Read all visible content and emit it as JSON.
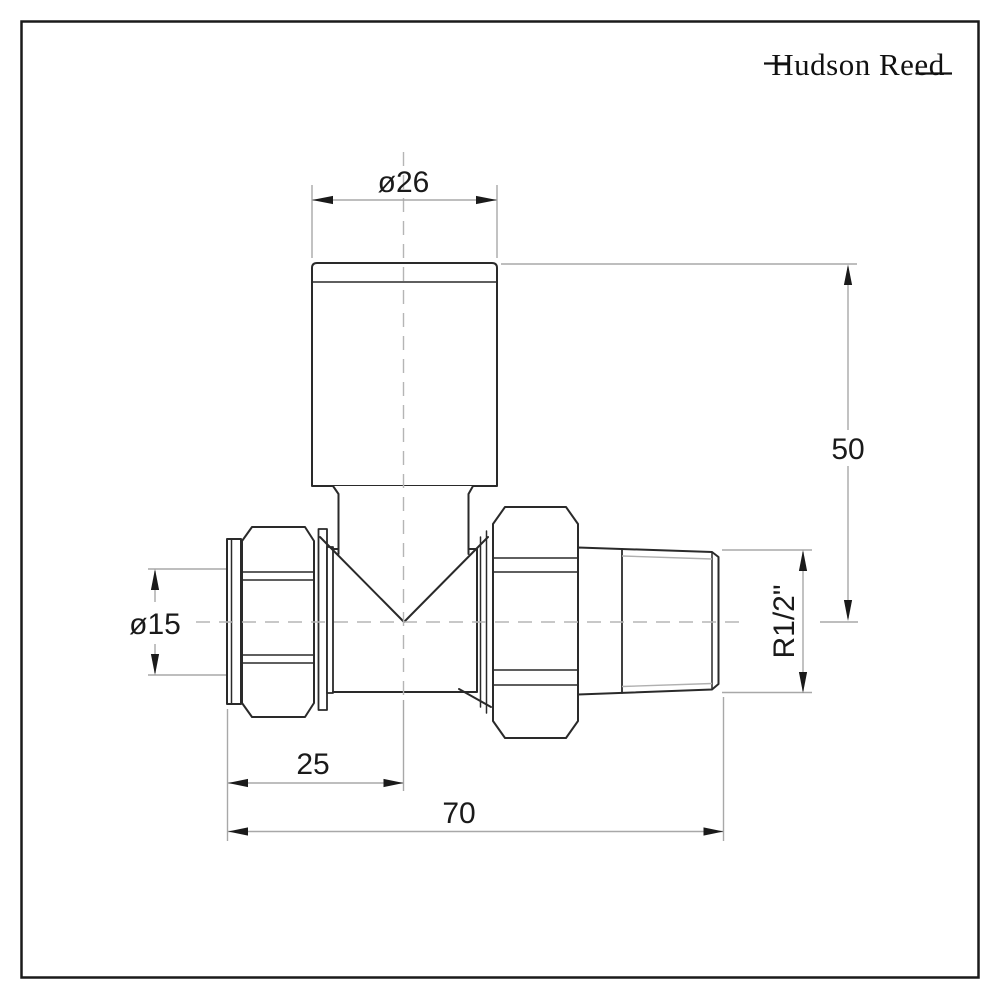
{
  "logo": {
    "text": "Hudson Reed"
  },
  "dimensions": {
    "head_diameter": {
      "label": "ø26"
    },
    "height_to_centerline": {
      "label": "50"
    },
    "inlet_diameter": {
      "label": "ø15"
    },
    "thread_size": {
      "label": "R1/2\""
    },
    "inlet_length": {
      "label": "25"
    },
    "overall_length": {
      "label": "70"
    }
  },
  "colors": {
    "background": "#ffffff",
    "frame_border": "#1a1a1a",
    "part_outline": "#2a2a2a",
    "dimension_lines": "#a8a8a8",
    "centerlines": "#b5b5b5",
    "text": "#1a1a1a"
  }
}
